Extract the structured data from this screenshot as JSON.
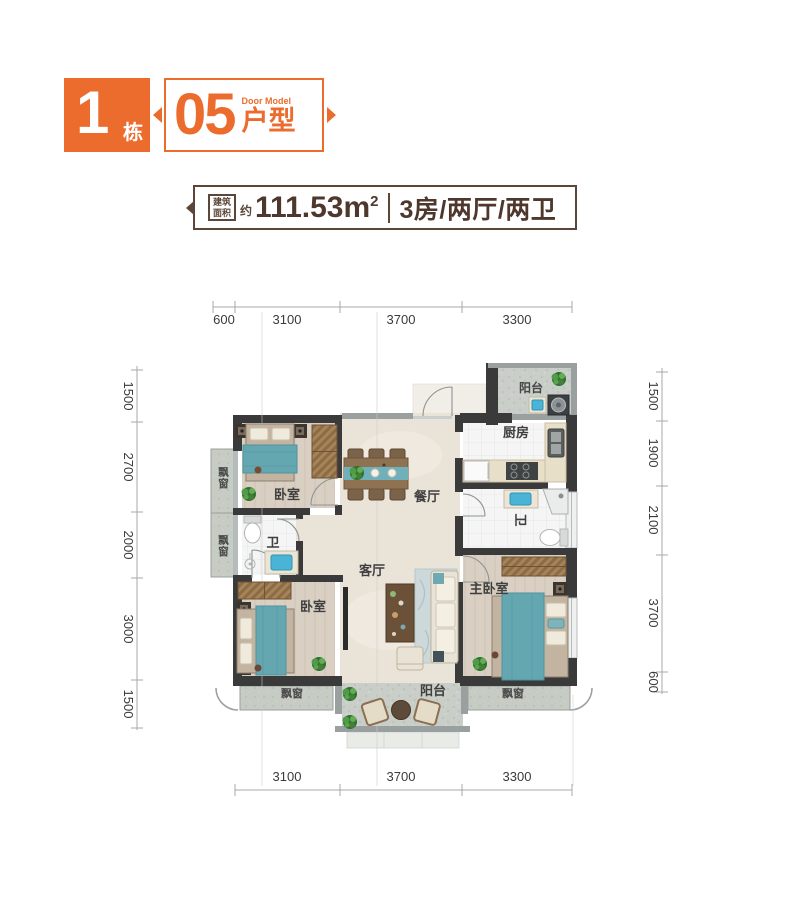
{
  "header": {
    "building_number": "1",
    "building_unit": "栋",
    "model_number": "05",
    "model_label": "户型",
    "model_sublabel": "Door Model",
    "accent_color": "#EC6C2D"
  },
  "info_bar": {
    "area_label_line1": "建筑",
    "area_label_line2": "面积",
    "approx": "约",
    "area_value": "111.53m",
    "area_superscript": "2",
    "layout": "3房/两厅/两卫",
    "text_color": "#4e372c"
  },
  "plan": {
    "rooms": {
      "balcony_top": "阳台",
      "kitchen": "厨房",
      "dining": "餐厅",
      "bedroom_top": "卧室",
      "bath_left": "卫",
      "bedroom_bottom": "卧室",
      "living": "客厅",
      "bath_right": "卫",
      "master_bedroom": "主卧室",
      "balcony_bottom": "阳台",
      "bay_left_top": "飘窗",
      "bay_left_bottom": "飘窗",
      "bay_bottom_left": "飘窗",
      "bay_bottom_right": "飘窗"
    },
    "dimensions": {
      "top": [
        "600",
        "3100",
        "3700",
        "3300"
      ],
      "bottom": [
        "3100",
        "3700",
        "3300"
      ],
      "left": [
        "1500",
        "2700",
        "2000",
        "3000",
        "1500"
      ],
      "right": [
        "1500",
        "1900",
        "2100",
        "3700",
        "600"
      ]
    },
    "colors": {
      "wall": "#3a3a3a",
      "wall_light": "#9aa0a0",
      "bed_teal": "#64a7b1",
      "wood_floor": "#d9cfc2",
      "stone_floor": "#c9cec8"
    }
  }
}
